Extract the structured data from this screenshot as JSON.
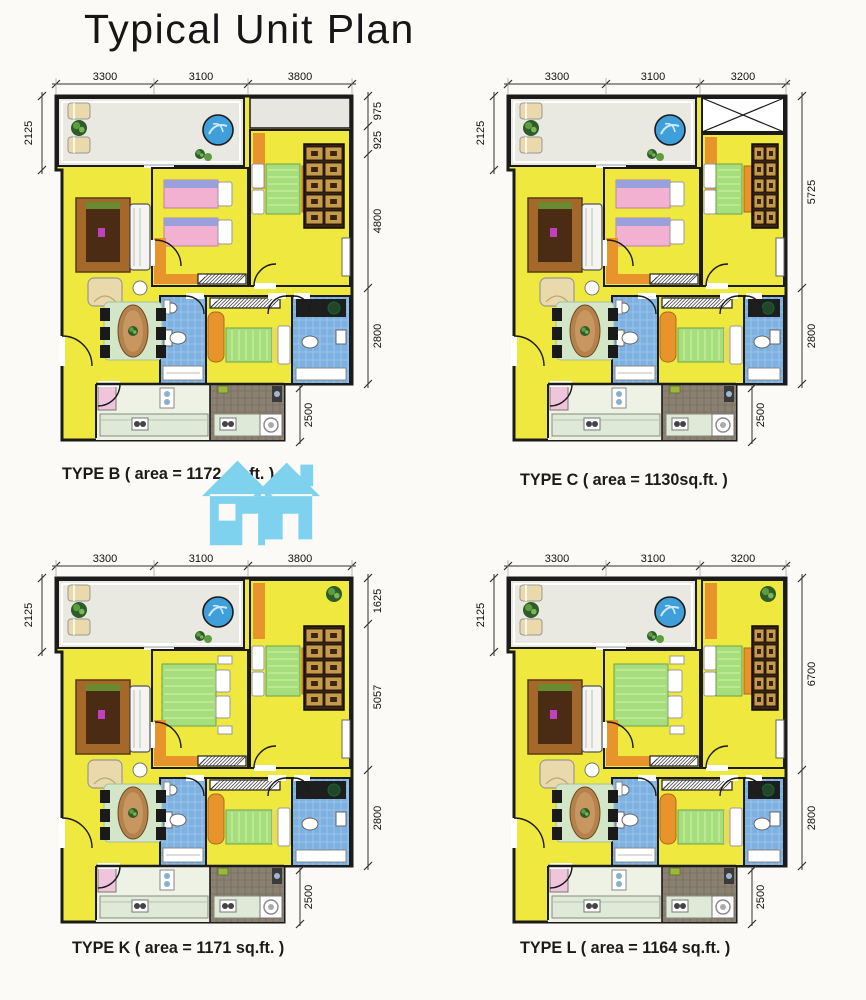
{
  "title": "Typical Unit Plan",
  "watermark_color": "#7fd2ee",
  "plans": [
    {
      "id": "B",
      "caption": "TYPE B ( area = 1172 sq.ft. )",
      "top_dims": [
        "3300",
        "3100",
        "3800"
      ],
      "left_dim": "2125",
      "right_dims": [
        "975",
        "925",
        "4800",
        "2800"
      ],
      "notch_dim": "2500"
    },
    {
      "id": "C",
      "caption": "TYPE C ( area = 1130sq.ft. )",
      "top_dims": [
        "3300",
        "3100",
        "3200"
      ],
      "left_dim": "2125",
      "right_dims": [
        "5725",
        "2800"
      ],
      "notch_dim": "2500"
    },
    {
      "id": "K",
      "caption": "TYPE K ( area = 1171 sq.ft. )",
      "top_dims": [
        "3300",
        "3100",
        "3800"
      ],
      "left_dim": "2125",
      "right_dims": [
        "1625",
        "5057",
        "2800"
      ],
      "notch_dim": "2500"
    },
    {
      "id": "L",
      "caption": "TYPE L ( area = 1164 sq.ft. )",
      "top_dims": [
        "3300",
        "3100",
        "3200"
      ],
      "left_dim": "2125",
      "right_dims": [
        "6700",
        "2800"
      ],
      "notch_dim": "2500"
    }
  ]
}
